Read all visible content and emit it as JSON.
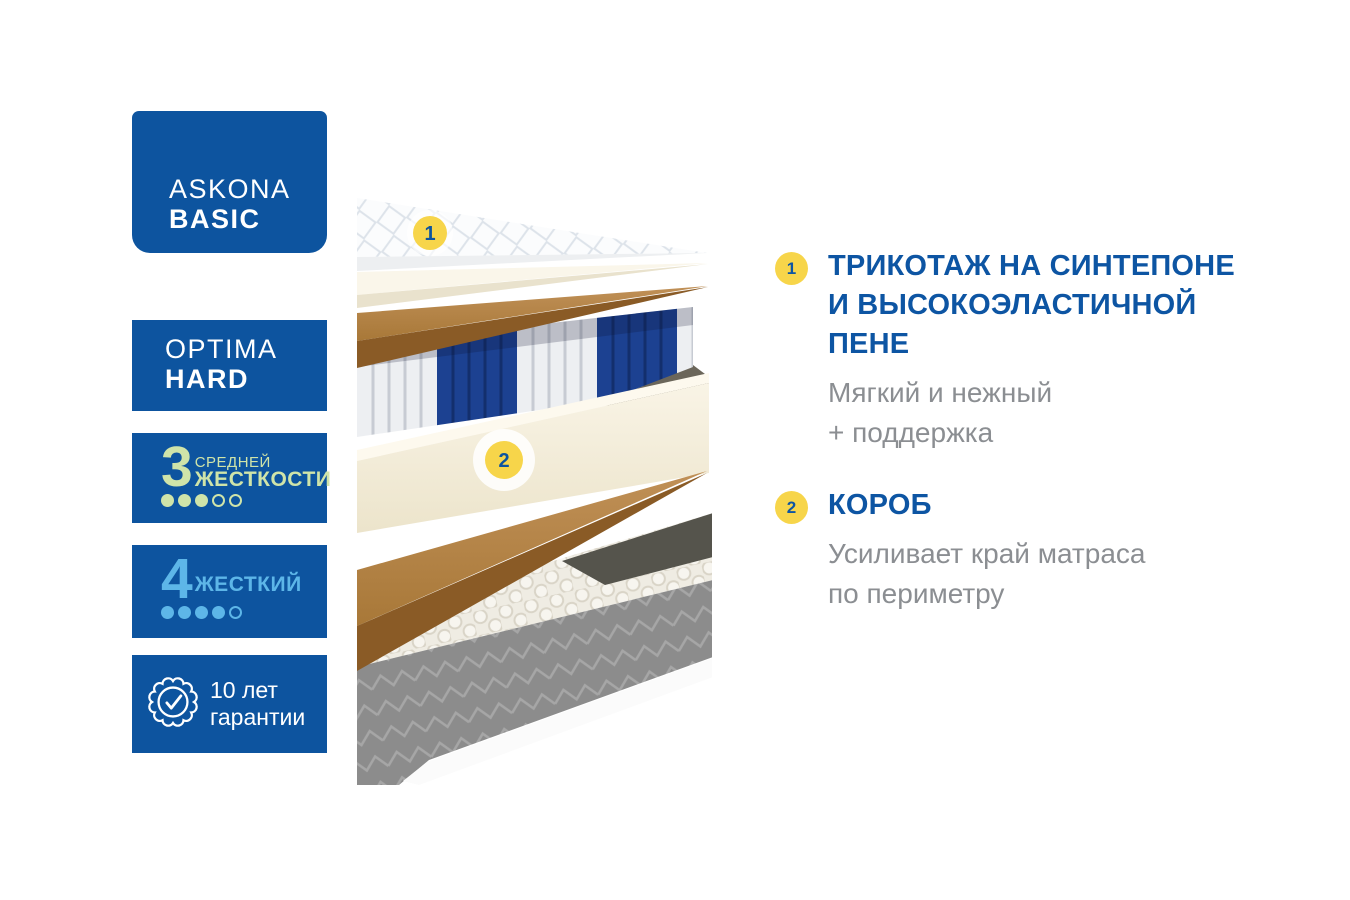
{
  "badges": {
    "brand": {
      "line1": "ASKONA",
      "line2": "BASIC"
    },
    "model": {
      "line1": "OPTIMA",
      "line2": "HARD"
    },
    "firmness_scale": {
      "value": "3",
      "label_line1": "СРЕДНЕЙ",
      "label_line2": "ЖЕСТКОСТИ",
      "dots_filled": 3,
      "dots_total": 5
    },
    "firmness_flip": {
      "value": "4",
      "label": "ЖЕСТКИЙ",
      "dots_filled": 4,
      "dots_total": 5
    },
    "warranty": {
      "line1": "10 лет",
      "line2": "гарантии"
    }
  },
  "diagram": {
    "marker1": "1",
    "marker2": "2",
    "layers": [
      "quilted-knit-cover",
      "foam-sheet",
      "coir-sheet",
      "pocket-spring-block",
      "foam-perimeter-box",
      "coir-sheet",
      "quilted-base-block"
    ]
  },
  "features": {
    "item1": {
      "number": "1",
      "title_line1": "ТРИКОТАЖ НА СИНТЕПОНЕ",
      "title_line2": "И ВЫСОКОЭЛАСТИЧНОЙ",
      "title_line3": "ПЕНЕ",
      "desc_line1": "Мягкий и нежный",
      "desc_line2": "+ поддержка"
    },
    "item2": {
      "number": "2",
      "title_line1": "КОРОБ",
      "desc_line1": "Усиливает край матраса",
      "desc_line2": "по периметру"
    }
  },
  "colors": {
    "badge_blue": "#0d549f",
    "title_blue": "#0d55a3",
    "body_gray": "#8b8e92",
    "accent_yellow": "#f7d54a",
    "firmness_green": "#cfe4a9",
    "firmness_light_blue": "#5db6e8",
    "spring_blue": "#1c4191",
    "coir_brown": "#b28343",
    "base_gray": "#8c8c8c"
  }
}
